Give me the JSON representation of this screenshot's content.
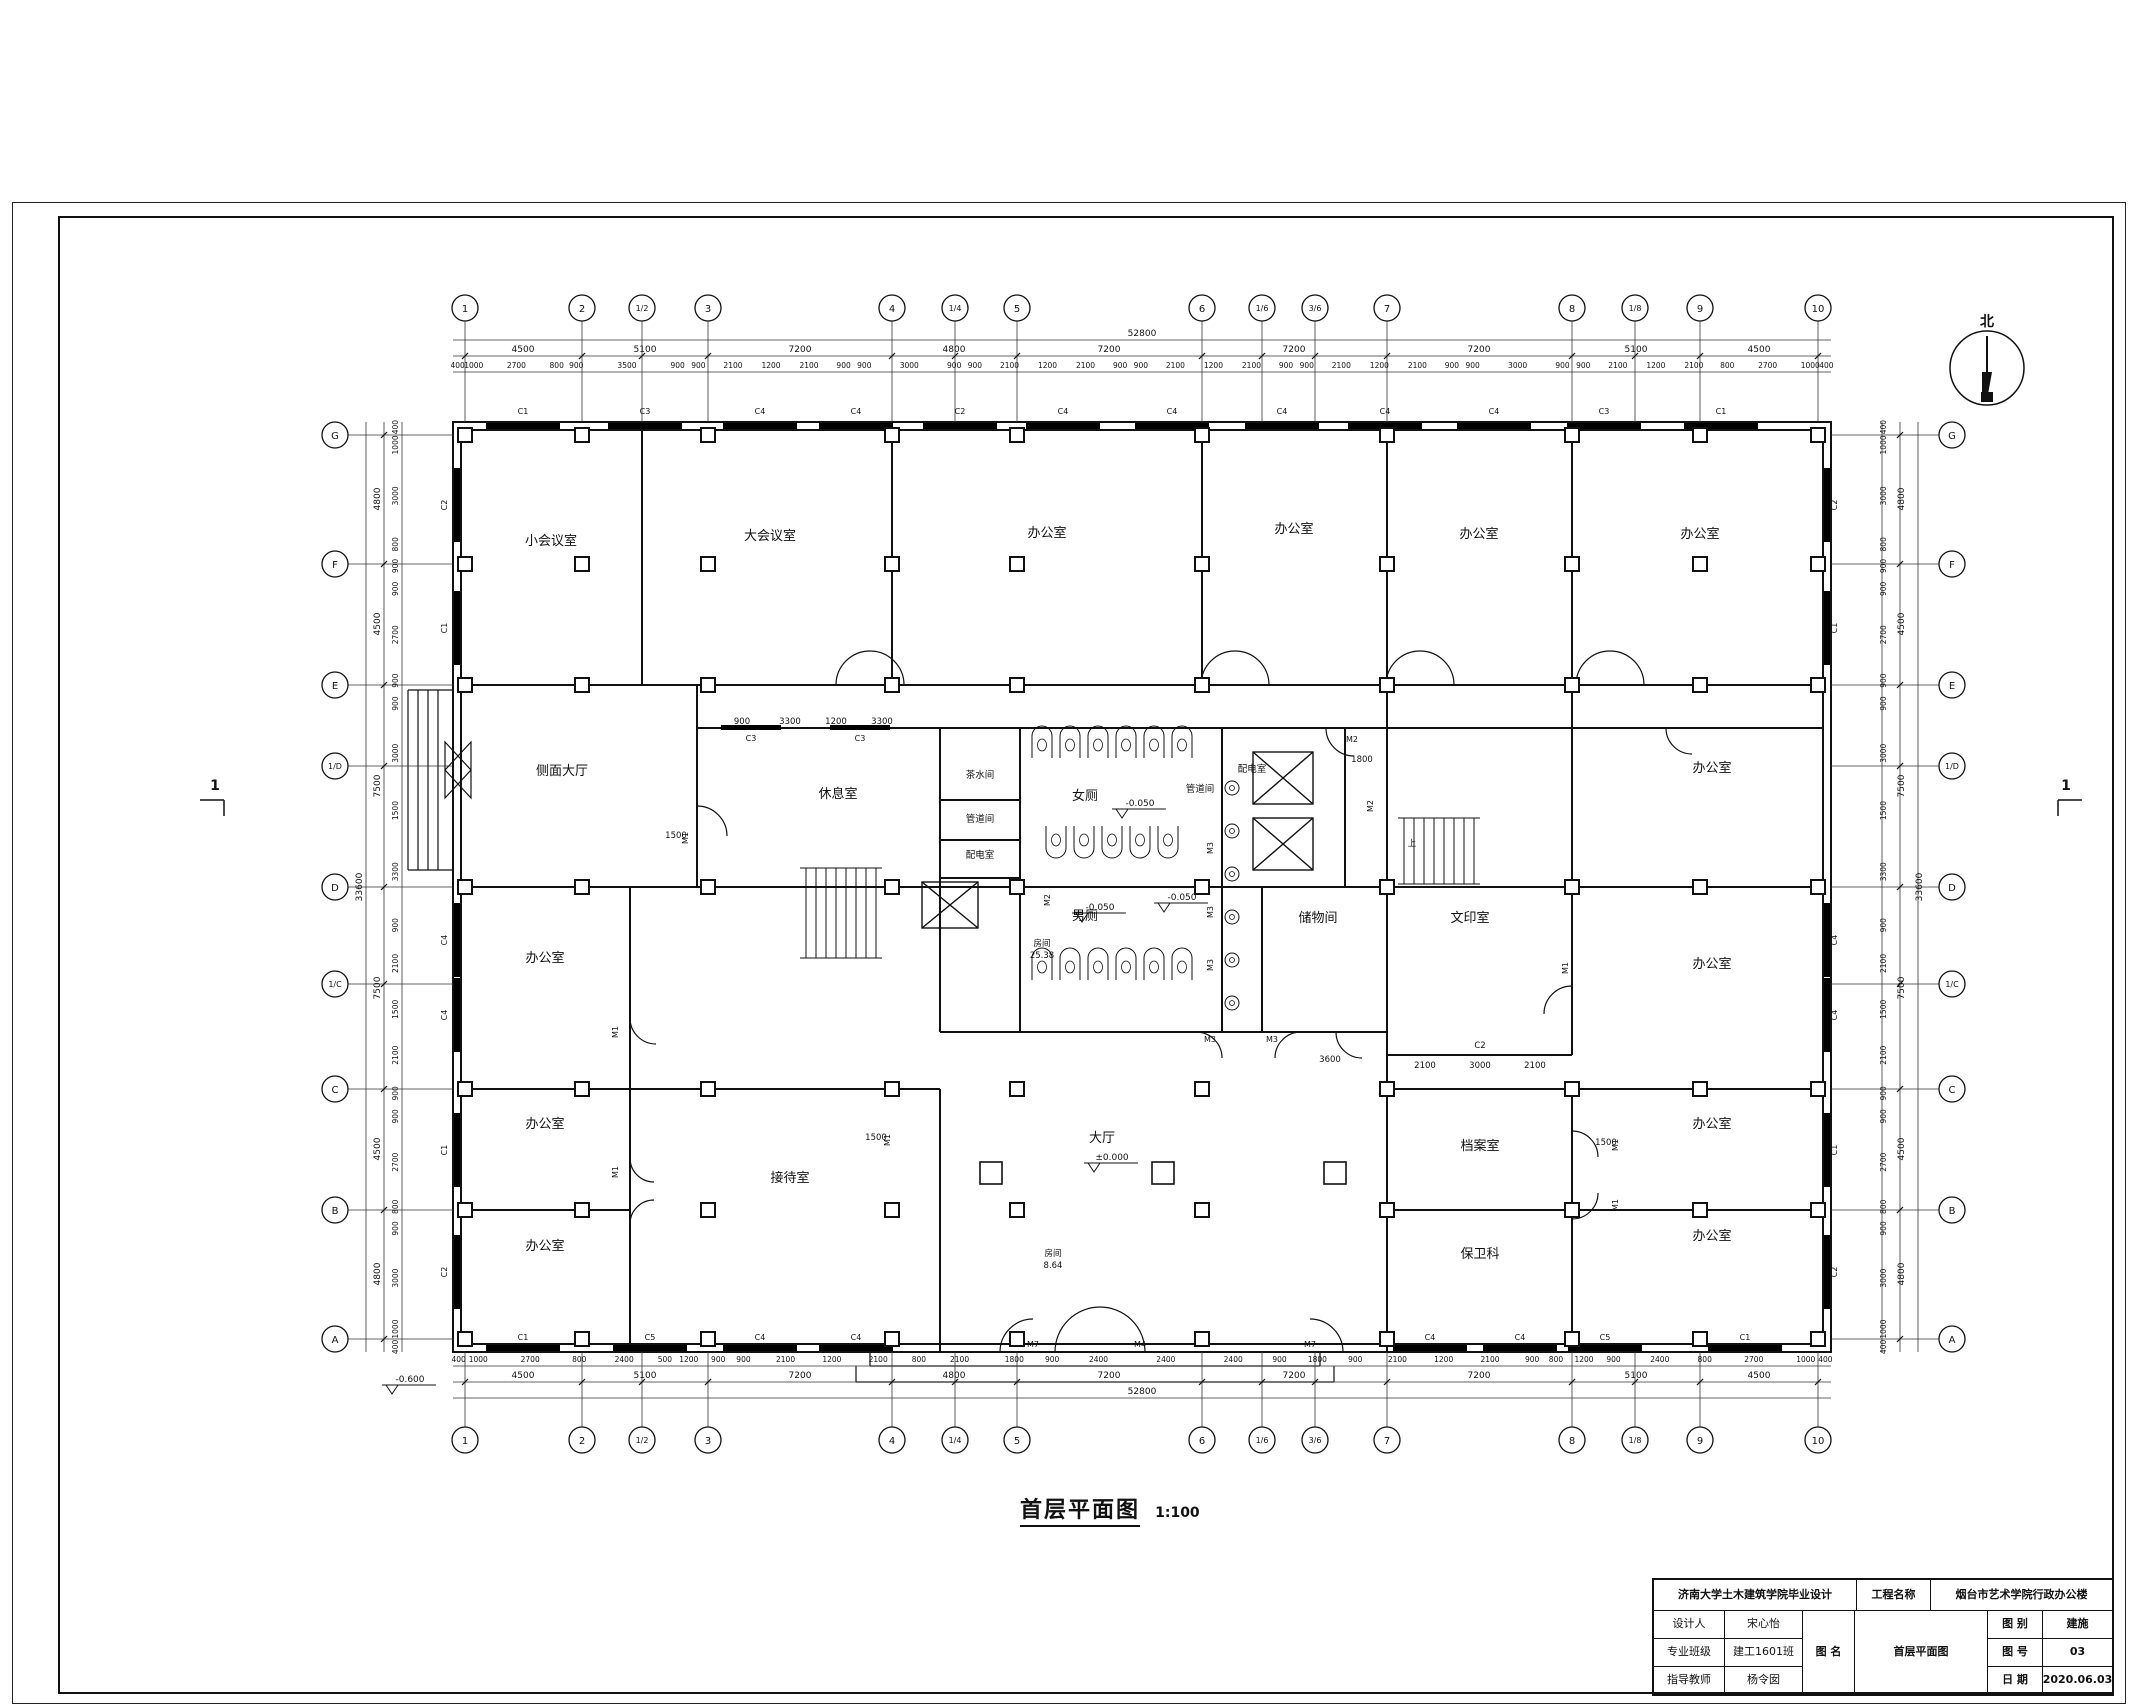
{
  "sheet": {
    "drawing_title": "首层平面图",
    "drawing_scale": "1:100",
    "north_label": "北",
    "section_marker": "1"
  },
  "title_block": {
    "school": "济南大学土木建筑学院毕业设计",
    "project_label": "工程名称",
    "project_name": "烟台市艺术学院行政办公楼",
    "designer_label": "设计人",
    "designer": "宋心怡",
    "class_label": "专业班级",
    "class_value": "建工1601班",
    "advisor_label": "指导教师",
    "advisor": "杨令囡",
    "dwgname_label": "图 名",
    "dwgname": "首层平面图",
    "category_label": "图 别",
    "category": "建施",
    "number_label": "图 号",
    "number": "03",
    "date_label": "日 期",
    "date": "2020.06.03"
  },
  "grid": {
    "cols": [
      {
        "label": "1",
        "x": 465
      },
      {
        "label": "2",
        "x": 582
      },
      {
        "label": "1/2",
        "x": 642,
        "minor": true
      },
      {
        "label": "3",
        "x": 708
      },
      {
        "label": "4",
        "x": 892
      },
      {
        "label": "1/4",
        "x": 955,
        "minor": true
      },
      {
        "label": "5",
        "x": 1017
      },
      {
        "label": "6",
        "x": 1202
      },
      {
        "label": "1/6",
        "x": 1262,
        "minor": true
      },
      {
        "label": "3/6",
        "x": 1315,
        "minor": true
      },
      {
        "label": "7",
        "x": 1387
      },
      {
        "label": "8",
        "x": 1572
      },
      {
        "label": "1/8",
        "x": 1635,
        "minor": true
      },
      {
        "label": "9",
        "x": 1700
      },
      {
        "label": "10",
        "x": 1818
      }
    ],
    "rows": [
      {
        "label": "G",
        "y": 435
      },
      {
        "label": "F",
        "y": 564
      },
      {
        "label": "E",
        "y": 685
      },
      {
        "label": "1/D",
        "y": 766,
        "minor": true
      },
      {
        "label": "D",
        "y": 887
      },
      {
        "label": "1/C",
        "y": 984,
        "minor": true
      },
      {
        "label": "C",
        "y": 1089
      },
      {
        "label": "B",
        "y": 1210
      },
      {
        "label": "A",
        "y": 1339
      }
    ],
    "extra_columns": [
      [
        991,
        1173
      ],
      [
        1163,
        1173
      ],
      [
        1335,
        1173
      ]
    ]
  },
  "dims": {
    "top_total": "52800",
    "bottom_total": "52800",
    "side_total": "33600",
    "top_segments": [
      {
        "t": "4500",
        "x": 523
      },
      {
        "t": "5100",
        "x": 645
      },
      {
        "t": "7200",
        "x": 800
      },
      {
        "t": "4800",
        "x": 954
      },
      {
        "t": "7200",
        "x": 1109
      },
      {
        "t": "7200",
        "x": 1294
      },
      {
        "t": "7200",
        "x": 1479
      },
      {
        "t": "5100",
        "x": 1636
      },
      {
        "t": "4500",
        "x": 1759
      }
    ],
    "side_segments": [
      {
        "t": "4800",
        "y": 499
      },
      {
        "t": "4500",
        "y": 624
      },
      {
        "t": "7500",
        "y": 786
      },
      {
        "t": "7500",
        "y": 988
      },
      {
        "t": "4500",
        "y": 1149
      },
      {
        "t": "4800",
        "y": 1274
      }
    ],
    "top_details": [
      "400",
      "1000",
      "2700",
      "800",
      "900",
      "3500",
      "900",
      "900",
      "2100",
      "1200",
      "2100",
      "900",
      "900",
      "3000",
      "900",
      "900",
      "2100",
      "1200",
      "2100",
      "900",
      "900",
      "2100",
      "1200",
      "2100",
      "900",
      "900",
      "2100",
      "1200",
      "2100",
      "900",
      "900",
      "3000",
      "900",
      "900",
      "2100",
      "1200",
      "2100",
      "800",
      "2700",
      "1000",
      "400"
    ],
    "bottom_details": [
      "400",
      "1000",
      "2700",
      "800",
      "2400",
      "500",
      "1200",
      "900",
      "900",
      "2100",
      "1200",
      "2100",
      "800",
      "2100",
      "1800",
      "900",
      "2400",
      "2400",
      "2400",
      "900",
      "1800",
      "900",
      "2100",
      "1200",
      "2100",
      "900",
      "800",
      "1200",
      "900",
      "2400",
      "800",
      "2700",
      "1000",
      "400"
    ],
    "side_details": [
      "400",
      "1000",
      "3000",
      "800",
      "900",
      "900",
      "2700",
      "900",
      "900",
      "3000",
      "1500",
      "3300",
      "900",
      "2100",
      "1500",
      "2100",
      "900",
      "900",
      "2700",
      "800",
      "900",
      "3000",
      "1000",
      "400"
    ]
  },
  "rooms": [
    {
      "name": "小会议室",
      "x": 551,
      "y": 545
    },
    {
      "name": "大会议室",
      "x": 770,
      "y": 540
    },
    {
      "name": "办公室",
      "x": 1047,
      "y": 537
    },
    {
      "name": "办公室",
      "x": 1294,
      "y": 533
    },
    {
      "name": "办公室",
      "x": 1479,
      "y": 538
    },
    {
      "name": "办公室",
      "x": 1700,
      "y": 538
    },
    {
      "name": "侧面大厅",
      "x": 562,
      "y": 775
    },
    {
      "name": "休息室",
      "x": 838,
      "y": 798
    },
    {
      "name": "茶水间",
      "x": 980,
      "y": 778,
      "small": true
    },
    {
      "name": "管道间",
      "x": 980,
      "y": 822,
      "small": true
    },
    {
      "name": "配电室",
      "x": 980,
      "y": 858,
      "small": true
    },
    {
      "name": "管道间",
      "x": 1200,
      "y": 792,
      "small": true
    },
    {
      "name": "配电室",
      "x": 1252,
      "y": 772,
      "small": true
    },
    {
      "name": "女厕",
      "x": 1085,
      "y": 800
    },
    {
      "name": "男厕",
      "x": 1085,
      "y": 920
    },
    {
      "name": "储物间",
      "x": 1318,
      "y": 922
    },
    {
      "name": "文印室",
      "x": 1470,
      "y": 922
    },
    {
      "name": "办公室",
      "x": 1712,
      "y": 772
    },
    {
      "name": "办公室",
      "x": 1712,
      "y": 968
    },
    {
      "name": "办公室",
      "x": 545,
      "y": 962
    },
    {
      "name": "办公室",
      "x": 545,
      "y": 1128
    },
    {
      "name": "办公室",
      "x": 545,
      "y": 1250
    },
    {
      "name": "接待室",
      "x": 790,
      "y": 1182
    },
    {
      "name": "大厅",
      "x": 1102,
      "y": 1142
    },
    {
      "name": "档案室",
      "x": 1480,
      "y": 1150
    },
    {
      "name": "保卫科",
      "x": 1480,
      "y": 1258
    },
    {
      "name": "办公室",
      "x": 1712,
      "y": 1128
    },
    {
      "name": "办公室",
      "x": 1712,
      "y": 1240
    }
  ],
  "codes": [
    {
      "t": "C1",
      "x": 523,
      "y": 414,
      "side": "top"
    },
    {
      "t": "C3",
      "x": 645,
      "y": 414,
      "side": "top"
    },
    {
      "t": "C4",
      "x": 760,
      "y": 414,
      "side": "top"
    },
    {
      "t": "C4",
      "x": 856,
      "y": 414,
      "side": "top"
    },
    {
      "t": "C2",
      "x": 960,
      "y": 414,
      "side": "top"
    },
    {
      "t": "C4",
      "x": 1063,
      "y": 414,
      "side": "top"
    },
    {
      "t": "C4",
      "x": 1172,
      "y": 414,
      "side": "top"
    },
    {
      "t": "C4",
      "x": 1282,
      "y": 414,
      "side": "top"
    },
    {
      "t": "C4",
      "x": 1385,
      "y": 414,
      "side": "top"
    },
    {
      "t": "C4",
      "x": 1494,
      "y": 414,
      "side": "top"
    },
    {
      "t": "C3",
      "x": 1604,
      "y": 414,
      "side": "top"
    },
    {
      "t": "C1",
      "x": 1721,
      "y": 414,
      "side": "top"
    },
    {
      "t": "C3",
      "x": 751,
      "y": 741,
      "side": "mid"
    },
    {
      "t": "C3",
      "x": 860,
      "y": 741,
      "side": "mid"
    },
    {
      "t": "C1",
      "x": 523,
      "y": 1340,
      "side": "bottom"
    },
    {
      "t": "C5",
      "x": 650,
      "y": 1340,
      "side": "bottom"
    },
    {
      "t": "C4",
      "x": 760,
      "y": 1340,
      "side": "bottom"
    },
    {
      "t": "C4",
      "x": 856,
      "y": 1340,
      "side": "bottom"
    },
    {
      "t": "C4",
      "x": 1430,
      "y": 1340,
      "side": "bottom"
    },
    {
      "t": "C4",
      "x": 1520,
      "y": 1340,
      "side": "bottom"
    },
    {
      "t": "C5",
      "x": 1605,
      "y": 1340,
      "side": "bottom"
    },
    {
      "t": "C1",
      "x": 1745,
      "y": 1340,
      "side": "bottom"
    },
    {
      "t": "M7",
      "x": 1033,
      "y": 1347
    },
    {
      "t": "M4",
      "x": 1140,
      "y": 1347
    },
    {
      "t": "M7",
      "x": 1310,
      "y": 1347
    },
    {
      "t": "C2",
      "x": 447,
      "y": 505,
      "rot": -90,
      "side": "left"
    },
    {
      "t": "C1",
      "x": 447,
      "y": 628,
      "rot": -90,
      "side": "left"
    },
    {
      "t": "C4",
      "x": 447,
      "y": 940,
      "rot": -90,
      "side": "left"
    },
    {
      "t": "C4",
      "x": 447,
      "y": 1015,
      "rot": -90,
      "side": "left"
    },
    {
      "t": "C1",
      "x": 447,
      "y": 1150,
      "rot": -90,
      "side": "left"
    },
    {
      "t": "C2",
      "x": 447,
      "y": 1272,
      "rot": -90,
      "side": "left"
    },
    {
      "t": "C2",
      "x": 1837,
      "y": 505,
      "rot": -90,
      "side": "right"
    },
    {
      "t": "C1",
      "x": 1837,
      "y": 628,
      "rot": -90,
      "side": "right"
    },
    {
      "t": "C4",
      "x": 1837,
      "y": 940,
      "rot": -90,
      "side": "right"
    },
    {
      "t": "C4",
      "x": 1837,
      "y": 1015,
      "rot": -90,
      "side": "right"
    },
    {
      "t": "C1",
      "x": 1837,
      "y": 1150,
      "rot": -90,
      "side": "right"
    },
    {
      "t": "C2",
      "x": 1837,
      "y": 1272,
      "rot": -90,
      "side": "right"
    },
    {
      "t": "M1",
      "x": 688,
      "y": 838,
      "rot": -90
    },
    {
      "t": "M2",
      "x": 1373,
      "y": 806,
      "rot": -90
    },
    {
      "t": "M3",
      "x": 1213,
      "y": 848,
      "rot": -90
    },
    {
      "t": "M3",
      "x": 1213,
      "y": 912,
      "rot": -90
    },
    {
      "t": "M3",
      "x": 1213,
      "y": 965,
      "rot": -90
    },
    {
      "t": "M1",
      "x": 890,
      "y": 1140,
      "rot": -90
    },
    {
      "t": "M1",
      "x": 1568,
      "y": 968,
      "rot": -90
    },
    {
      "t": "M1",
      "x": 1618,
      "y": 1145,
      "rot": -90
    },
    {
      "t": "M1",
      "x": 1618,
      "y": 1205,
      "rot": -90
    },
    {
      "t": "M1",
      "x": 618,
      "y": 1032,
      "rot": -90
    },
    {
      "t": "M1",
      "x": 618,
      "y": 1172,
      "rot": -90
    },
    {
      "t": "M2",
      "x": 1050,
      "y": 900,
      "rot": -90
    },
    {
      "t": "M2",
      "x": 1352,
      "y": 742
    },
    {
      "t": "M3",
      "x": 1210,
      "y": 1042
    },
    {
      "t": "M3",
      "x": 1272,
      "y": 1042
    }
  ],
  "annotations": [
    {
      "t": "±0.000",
      "x": 1090,
      "y": 1160,
      "marker": true
    },
    {
      "t": "-0.050",
      "x": 1118,
      "y": 806,
      "marker": true
    },
    {
      "t": "-0.050",
      "x": 1078,
      "y": 910,
      "marker": true
    },
    {
      "t": "-0.050",
      "x": 1160,
      "y": 900,
      "marker": true
    },
    {
      "t": "-0.600",
      "x": 388,
      "y": 1382,
      "marker": true
    },
    {
      "t": "上",
      "x": 1412,
      "y": 846
    },
    {
      "t": "房间",
      "x": 1042,
      "y": 946
    },
    {
      "t": "25.38",
      "x": 1042,
      "y": 958
    },
    {
      "t": "房间",
      "x": 1053,
      "y": 1256
    },
    {
      "t": "8.64",
      "x": 1053,
      "y": 1268
    },
    {
      "t": "900",
      "x": 742,
      "y": 724
    },
    {
      "t": "3300",
      "x": 790,
      "y": 724
    },
    {
      "t": "1200",
      "x": 836,
      "y": 724
    },
    {
      "t": "3300",
      "x": 882,
      "y": 724
    },
    {
      "t": "2100",
      "x": 1425,
      "y": 1068
    },
    {
      "t": "3000",
      "x": 1480,
      "y": 1068
    },
    {
      "t": "2100",
      "x": 1535,
      "y": 1068
    },
    {
      "t": "C2",
      "x": 1480,
      "y": 1048
    },
    {
      "t": "3600",
      "x": 1330,
      "y": 1062
    },
    {
      "t": "1500",
      "x": 676,
      "y": 838,
      "rot": -90
    },
    {
      "t": "1500",
      "x": 876,
      "y": 1140,
      "rot": -90
    },
    {
      "t": "1500",
      "x": 1606,
      "y": 1145,
      "rot": -90
    },
    {
      "t": "1800",
      "x": 1362,
      "y": 762,
      "rot": -90
    },
    {
      "t": "北",
      "x": 1987,
      "y": 326,
      "big": true
    },
    {
      "t": "1",
      "x": 215,
      "y": 790,
      "big": true
    },
    {
      "t": "1",
      "x": 2066,
      "y": 790,
      "big": true
    }
  ]
}
